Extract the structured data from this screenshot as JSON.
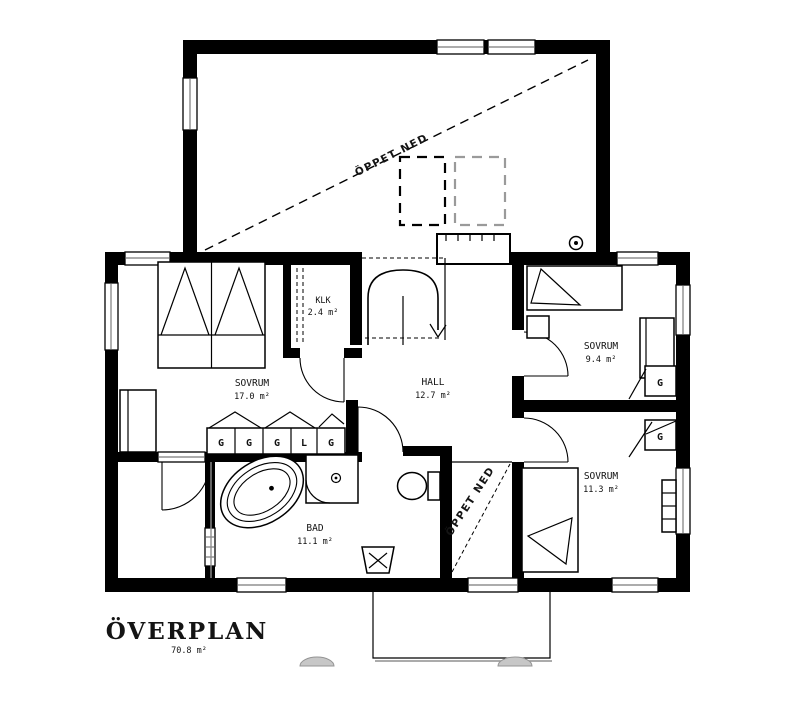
{
  "plan": {
    "title": "ÖVERPLAN",
    "total_area": "70.8 m²",
    "rooms": {
      "sovrum_large": {
        "name": "SOVRUM",
        "area": "17.0 m²"
      },
      "klk": {
        "name": "KLK",
        "area": "2.4 m²"
      },
      "hall": {
        "name": "HALL",
        "area": "12.7 m²"
      },
      "sovrum_ne": {
        "name": "SOVRUM",
        "area": "9.4 m²"
      },
      "sovrum_se": {
        "name": "SOVRUM",
        "area": "11.3 m²"
      },
      "bad": {
        "name": "BAD",
        "area": "11.1 m²"
      }
    },
    "open_below_upper": "ÖPPET NED",
    "open_below_lower": "ÖPPET NED",
    "wardrobes": {
      "w1": "G",
      "w2": "G",
      "w3": "G",
      "w4": "L",
      "w5": "G",
      "right_top": "G",
      "right_bottom": "G"
    },
    "colors": {
      "walls": "#000000",
      "background": "#ffffff",
      "shadow_gray": "#c7c7c7"
    }
  }
}
